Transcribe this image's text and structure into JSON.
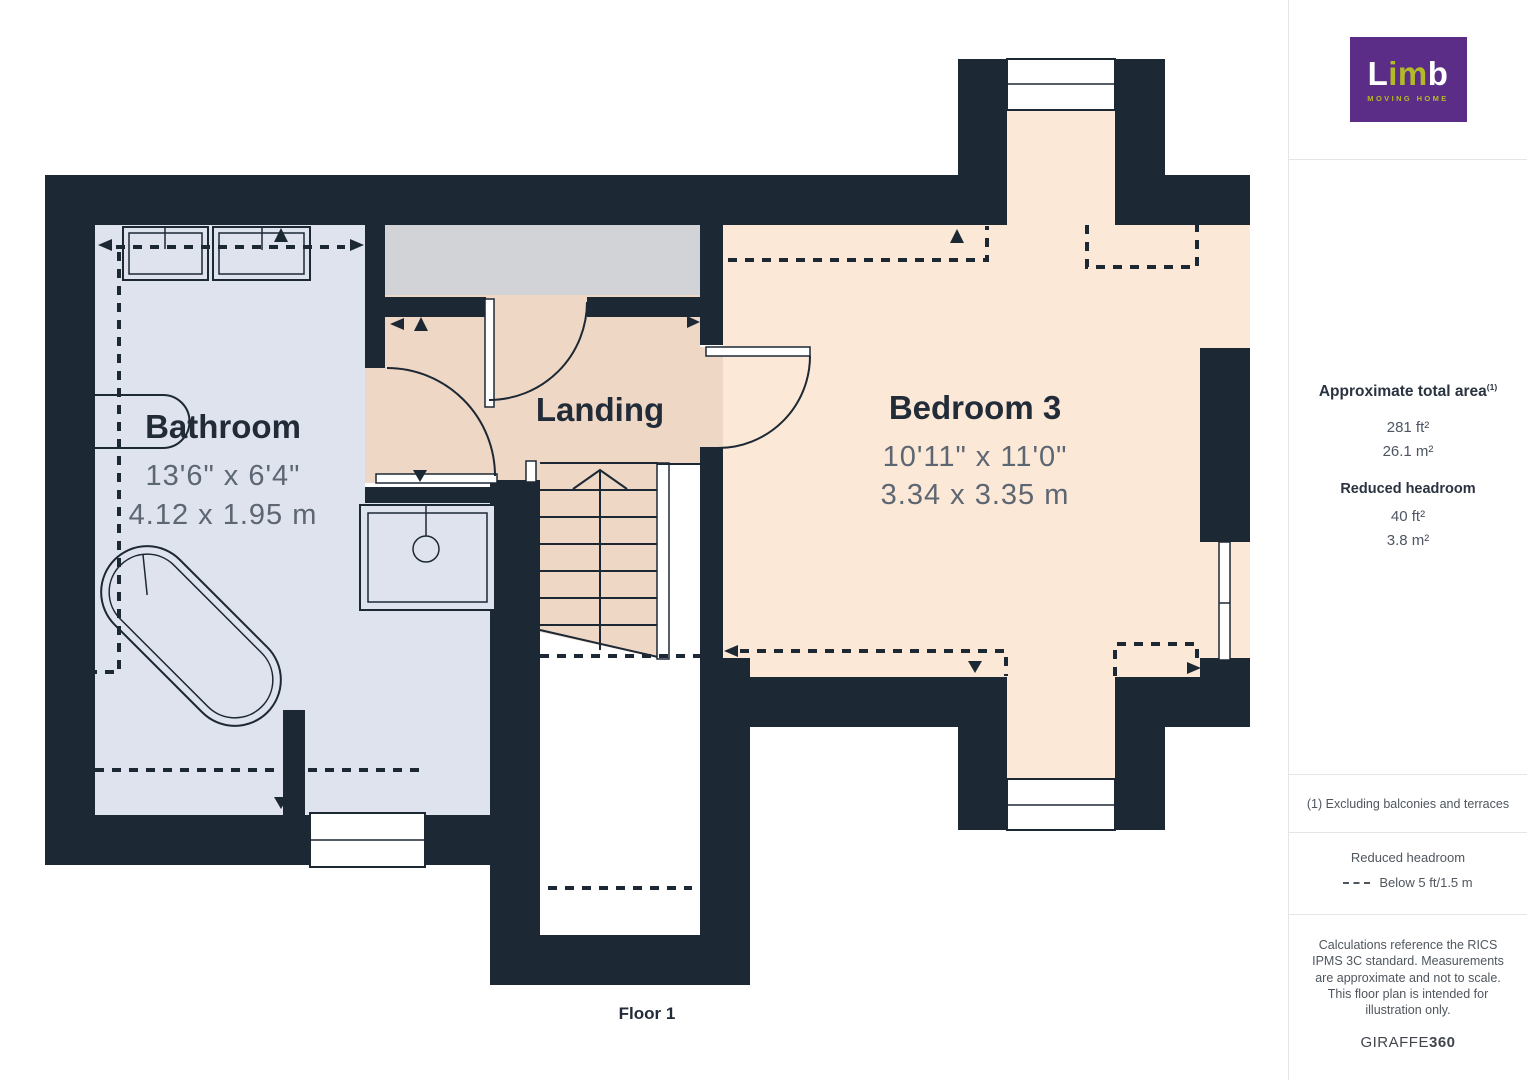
{
  "colors": {
    "wall": "#1d2835",
    "bathroom": "#dfe3ee",
    "landing": "#eed7c5",
    "bedroom": "#fbe8d6",
    "grayarea": "#d2d3d6",
    "label": "#222b38",
    "dim": "#5d6673",
    "logo-purple": "#5b2d86",
    "logo-green": "#b2ba25",
    "border": "#e3e5e8",
    "text-dark": "#2a3340",
    "text-gray": "#4d5663",
    "text-muted": "#4f565e"
  },
  "plan": {
    "floor_label": "Floor 1",
    "rooms": [
      {
        "name": "Bathroom",
        "dims_ft": "13'6\" x 6'4\"",
        "dims_m": "4.12 x 1.95 m"
      },
      {
        "name": "Landing"
      },
      {
        "name": "Bedroom 3",
        "dims_ft": "10'11\" x 11'0\"",
        "dims_m": "3.34 x 3.35 m"
      }
    ]
  },
  "sidebar": {
    "logo": {
      "brand_l": "L",
      "brand_im": "im",
      "brand_b": "b",
      "tagline": "MOVING HOME"
    },
    "area": {
      "title": "Approximate total area",
      "title_sup": "(1)",
      "total_ft": "281 ft²",
      "total_m": "26.1 m²",
      "reduced_title": "Reduced headroom",
      "reduced_ft": "40 ft²",
      "reduced_m": "3.8 m²"
    },
    "note": "(1) Excluding balconies and terraces",
    "legend": {
      "title": "Reduced headroom",
      "item": "Below 5 ft/1.5 m"
    },
    "disclaimer": "Calculations reference the RICS IPMS 3C standard. Measurements are approximate and not to scale. This floor plan is intended for illustration only.",
    "brand_footer_normal": "GIRAFFE",
    "brand_footer_bold": "360"
  }
}
